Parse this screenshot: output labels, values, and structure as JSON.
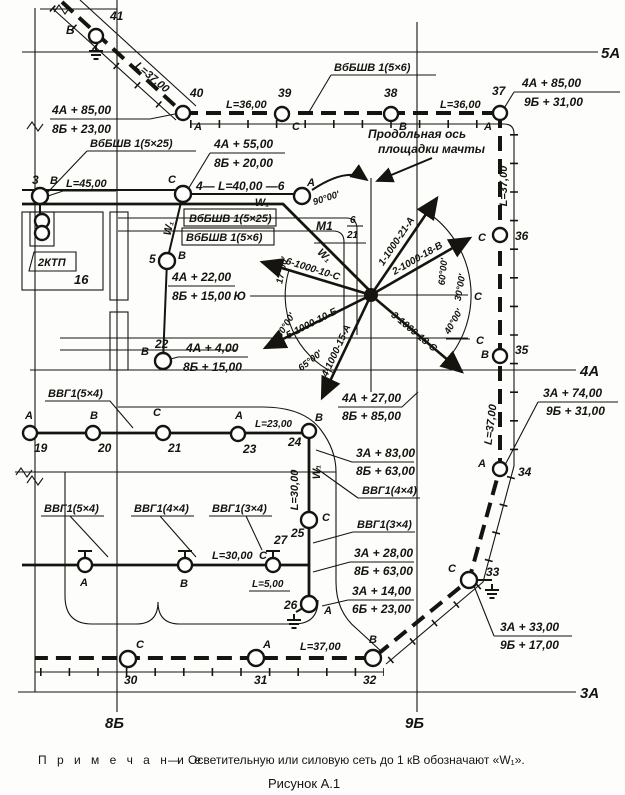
{
  "axes": {
    "a5": "5А",
    "a4": "4А",
    "a3": "3А",
    "b8": "8Б",
    "b9": "9Б"
  },
  "w1": "W₁",
  "top": {
    "n41": "41",
    "l41": "В",
    "len_diag": "L=37,00",
    "n40": "40",
    "l40": "А",
    "len36a": "L=36,00",
    "n39": "39",
    "l39": "С",
    "cable56": "ВбБШВ 1(5×6)",
    "n38": "38",
    "l38": "В",
    "len36b": "L=36,00",
    "n37": "37",
    "l37": "А"
  },
  "left": {
    "cable525": "ВбБШВ 1(5×25)",
    "len45": "L=45,00",
    "n3": "3",
    "l3": "В",
    "span46": "4— L=40,00 —6",
    "l6": "А",
    "box1": "ВбБШВ 1(5×25)",
    "box2": "ВбБШВ 1(5×6)",
    "ktp": "2КТП",
    "b16": "16",
    "n5": "5",
    "l5": "В",
    "n22": "22",
    "l22": "В"
  },
  "mast": {
    "axis1": "Продольная ось",
    "axis2": "площадки мачты",
    "m1": "М1",
    "m1_num": "6",
    "m1_den": "21",
    "south": "Ю",
    "ray_end_c": "С",
    "line_end_c": "С",
    "rays": [
      "1-1000-21-А",
      "2-1000-18-В",
      "3-1000-18-С",
      "4-1000-15-А",
      "5-1000-10-Б",
      "6-1000-10-С"
    ],
    "angles": {
      "a90": "90°00'",
      "a17": "17°00'",
      "a30l": "30°00'",
      "a65": "65°00'",
      "a60": "60°00'",
      "a30r": "30°00'",
      "a40": "40°00'"
    }
  },
  "right": {
    "n36": "36",
    "l36": "С",
    "n35": "35",
    "l35": "В",
    "n34": "34",
    "l34": "А",
    "n33": "33",
    "l33": "С",
    "len37a": "L=37,00",
    "len37b": "L=37,00"
  },
  "coords": {
    "fr1": {
      "t": "4А + 85,00",
      "b": "8Б + 23,00"
    },
    "fr2": {
      "t": "4А + 85,00",
      "b": "9Б + 31,00"
    },
    "fr3": {
      "t": "4А + 55,00",
      "b": "8Б + 20,00"
    },
    "fr4": {
      "t": "4А + 22,00",
      "b": "8Б + 15,00"
    },
    "fr5": {
      "t": "4А + 27,00",
      "b": "8Б + 85,00"
    },
    "fr6": {
      "t": "3А + 74,00",
      "b": "9Б + 31,00"
    },
    "fr7": {
      "t": "3А + 33,00",
      "b": "9Б + 17,00"
    },
    "fr8": {
      "t": "4А + 4,00",
      "b": "8Б + 15,00"
    },
    "fr9": {
      "t": "3А + 83,00",
      "b": "8Б + 63,00"
    },
    "fr10": {
      "t": "3А + 28,00",
      "b": "8Б + 63,00"
    },
    "fr11": {
      "t": "3А + 14,00",
      "b": "6Б + 23,00"
    }
  },
  "row": {
    "cable54": "ВВГ1(5×4)",
    "l19": "А",
    "n19": "19",
    "l20": "В",
    "n20": "20",
    "l21": "С",
    "n21": "21",
    "l23": "А",
    "n23": "23",
    "l24": "В",
    "n24": "24",
    "len23": "L=23,00"
  },
  "center_low": {
    "len30v": "L=30,00",
    "cable44": "ВВГ1(4×4)",
    "n25": "25",
    "l25": "С",
    "cable34": "ВВГ1(3×4)"
  },
  "bottom_left": {
    "cable54": "ВВГ1(5×4)",
    "cable44": "ВВГ1(4×4)",
    "cable34": "ВВГ1(3×4)",
    "len30": "L=30,00",
    "n27": "27",
    "l27": "С",
    "la": "А",
    "lb": "В",
    "len5": "L=5,00",
    "n26": "26",
    "l26": "А"
  },
  "bottom": {
    "n30": "30",
    "l30": "С",
    "n31": "31",
    "l31": "А",
    "n32": "32",
    "l32": "В",
    "len37": "L=37,00"
  },
  "footer": {
    "note_word": "П р и м е ч а н и е",
    "note_dash": "—",
    "note_text": "Осветительную или силовую сеть до 1 кВ обозначают «W₁».",
    "caption": "Рисунок А.1"
  }
}
